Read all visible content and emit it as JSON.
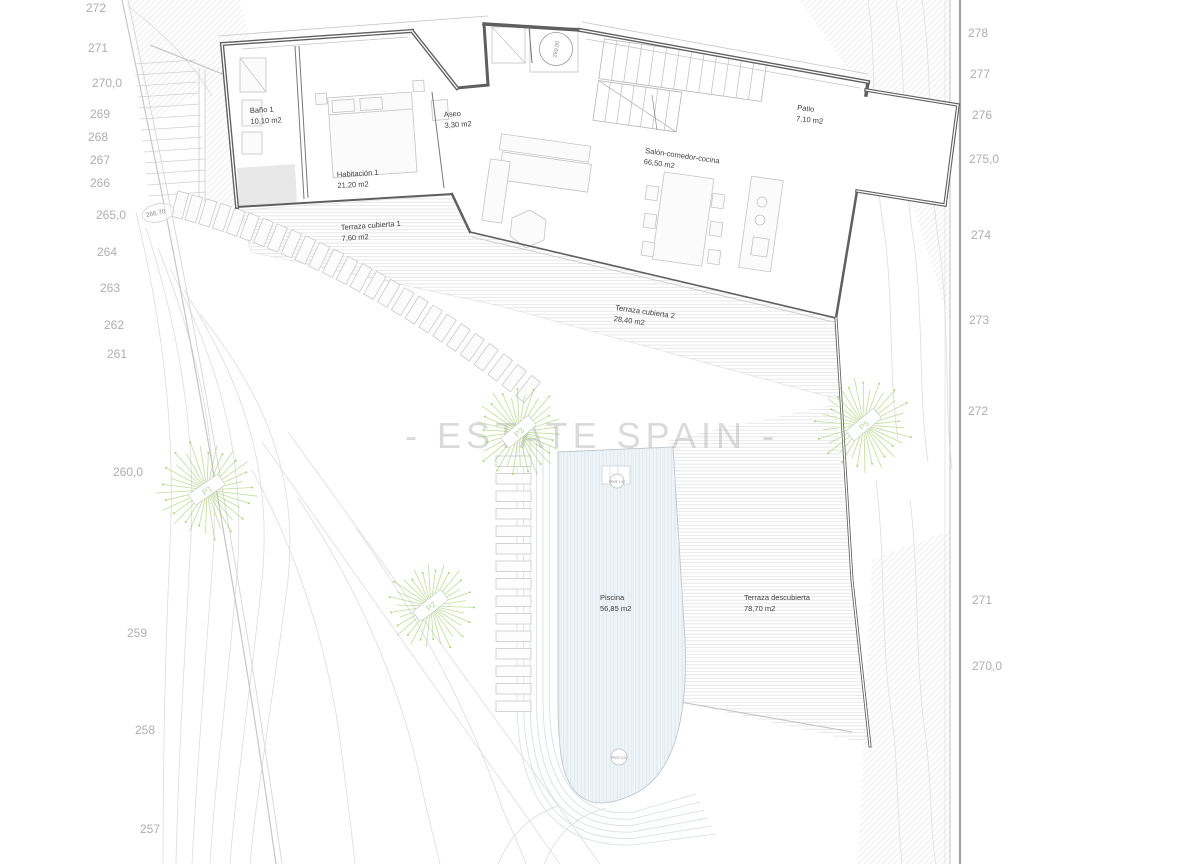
{
  "watermark": "- ESTATE SPAIN -",
  "plan": {
    "rooms": [
      {
        "name": "Baño 1",
        "area": "10,10 m2"
      },
      {
        "name": "Aseo",
        "area": "3,30 m2"
      },
      {
        "name": "Habitación 1",
        "area": "21,20 m2"
      },
      {
        "name": "Salón-comedor-cocina",
        "area": "66,50 m2"
      },
      {
        "name": "Patio",
        "area": "7,10 m2"
      },
      {
        "name": "Terraza cubierta 1",
        "area": "7,60 m2"
      },
      {
        "name": "Terraza cubierta 2",
        "area": "28,40 m2"
      },
      {
        "name": "Piscina",
        "area": "56,85 m2"
      },
      {
        "name": "Terraza descubierta",
        "area": "78,70 m2"
      }
    ],
    "levels": {
      "entry": "269,00",
      "path": "266,70"
    },
    "pool_markers": {
      "top": "PROF 1,50",
      "bottom": "PROF 2,00"
    },
    "trees": [
      {
        "label": "P1"
      },
      {
        "label": "P3"
      },
      {
        "label": "P2"
      },
      {
        "label": "P5"
      }
    ]
  },
  "elevations": {
    "left": [
      "272",
      "271",
      "270,0",
      "269",
      "268",
      "267",
      "266",
      "265,0",
      "264",
      "263",
      "262",
      "261",
      "260,0",
      "259",
      "258",
      "257"
    ],
    "right": [
      "278",
      "277",
      "276",
      "275,0",
      "274",
      "273",
      "272",
      "271",
      "270,0"
    ]
  },
  "colors": {
    "tree_green": "#9ccc65",
    "wall_gray": "#5f5f5f",
    "contour_gray": "#dcdcdc",
    "step_gray": "#c9c9c9",
    "pool_fill": "#eef4f8",
    "pool_line": "#d6dde1",
    "elevation_gray": "#aeaeae",
    "watermark_gray": "#a9a9a9"
  }
}
